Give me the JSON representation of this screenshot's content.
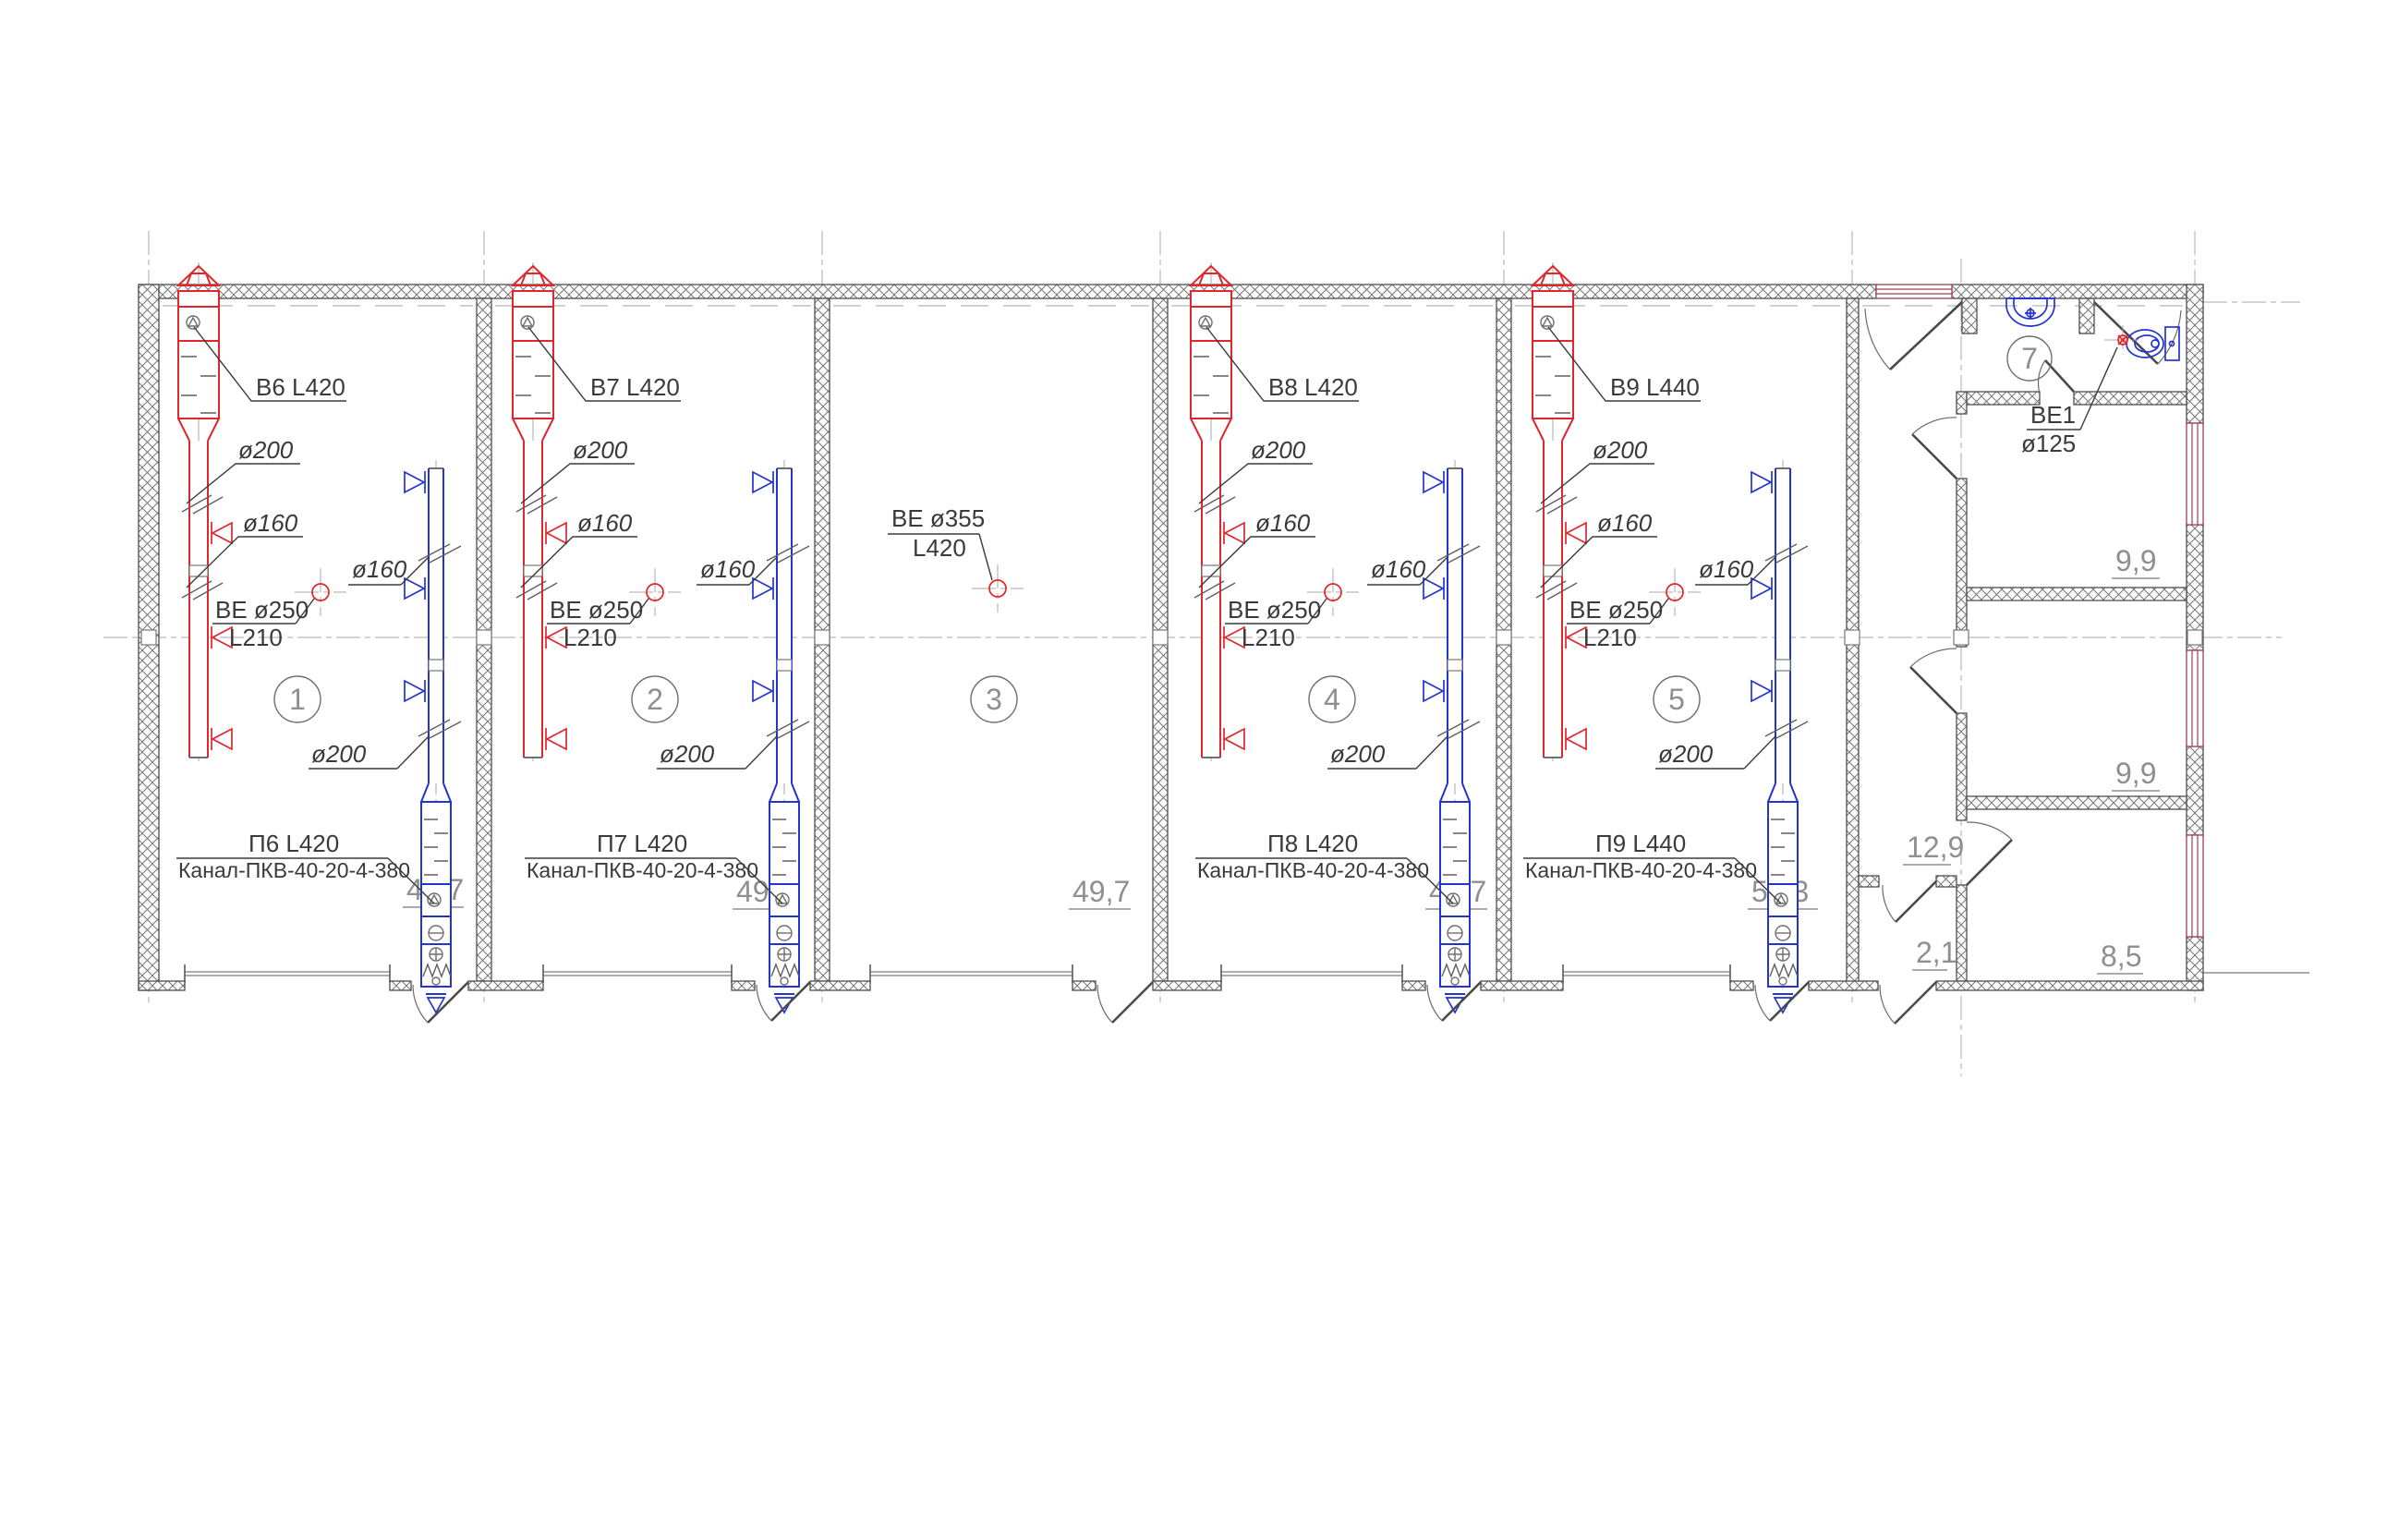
{
  "colors": {
    "exhaust": "#e2262b",
    "supply": "#2334cf",
    "window": "#9a4253"
  },
  "plan": {
    "rooms": [
      {
        "number": "1",
        "area": "49,7",
        "exhaust_tag": "В6 L420",
        "exhaust_d1": "ø200",
        "exhaust_d2": "ø160",
        "fan_tag": "ВЕ ø250",
        "fan_len": "L210",
        "supply_d1": "ø160",
        "supply_d2": "ø200",
        "supply_tag": "П6 L420",
        "supply_unit": "Канал-ПКВ-40-20-4-380"
      },
      {
        "number": "2",
        "area": "49,7",
        "exhaust_tag": "В7 L420",
        "exhaust_d1": "ø200",
        "exhaust_d2": "ø160",
        "fan_tag": "ВЕ ø250",
        "fan_len": "L210",
        "supply_d1": "ø160",
        "supply_d2": "ø200",
        "supply_tag": "П7 L420",
        "supply_unit": "Канал-ПКВ-40-20-4-380"
      },
      {
        "number": "3",
        "area": "49,7",
        "roof_fan_tag": "ВЕ ø355",
        "roof_fan_len": "L420"
      },
      {
        "number": "4",
        "area": "49,7",
        "exhaust_tag": "В8 L420",
        "exhaust_d1": "ø200",
        "exhaust_d2": "ø160",
        "fan_tag": "ВЕ ø250",
        "fan_len": "L210",
        "supply_d1": "ø160",
        "supply_d2": "ø200",
        "supply_tag": "П8 L420",
        "supply_unit": "Канал-ПКВ-40-20-4-380"
      },
      {
        "number": "5",
        "area": "52,3",
        "exhaust_tag": "В9 L440",
        "exhaust_d1": "ø200",
        "exhaust_d2": "ø160",
        "fan_tag": "ВЕ ø250",
        "fan_len": "L210",
        "supply_d1": "ø160",
        "supply_d2": "ø200",
        "supply_tag": "П9 L440",
        "supply_unit": "Канал-ПКВ-40-20-4-380"
      }
    ],
    "wc_room": {
      "number": "7",
      "fan_tag": "ВЕ1",
      "fan_dia": "ø125"
    },
    "side_rooms": {
      "corridor_area": "12,9",
      "room_a_area": "9,9",
      "room_b_area": "9,9",
      "vestibule_area": "2,1",
      "room_c_area": "8,5"
    }
  }
}
